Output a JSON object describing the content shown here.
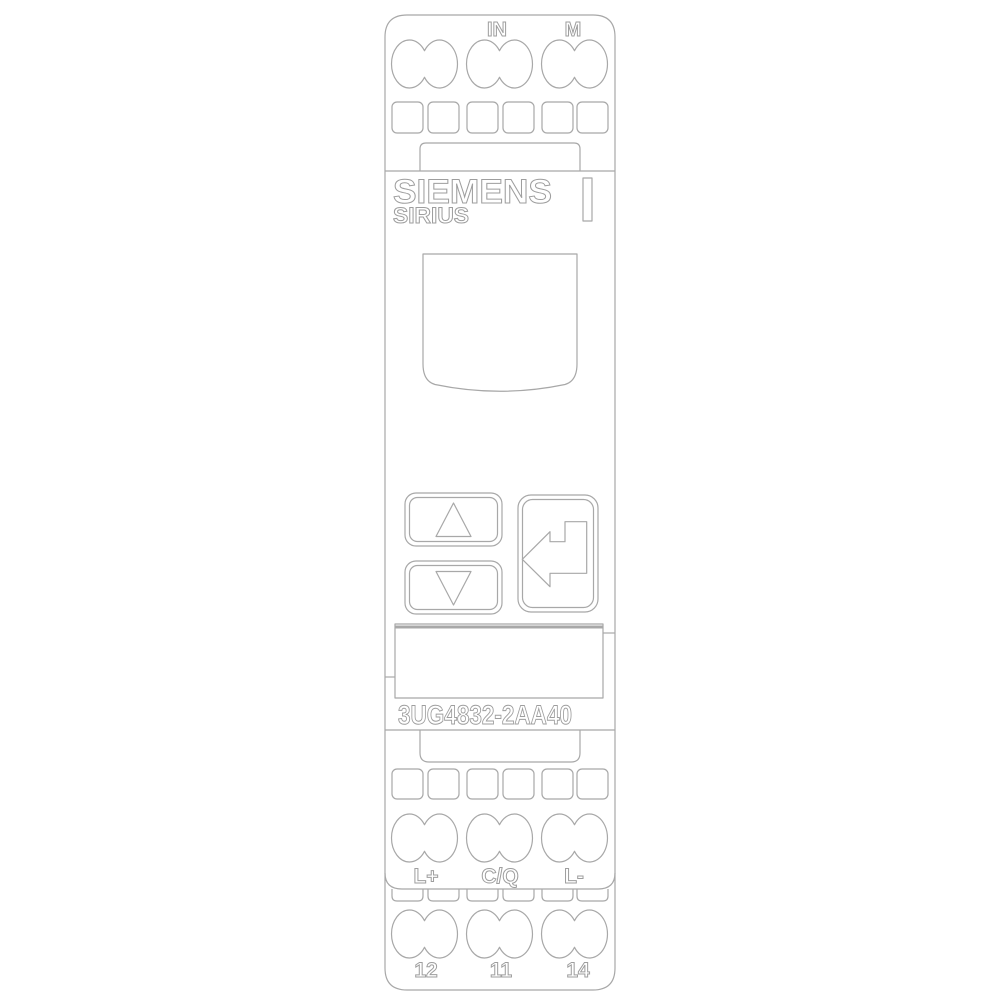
{
  "device": {
    "brand": "SIEMENS",
    "series": "SIRIUS",
    "model": "3UG4832-2AA40"
  },
  "terminals": {
    "top": {
      "labels": [
        "IN",
        "M"
      ]
    },
    "io": {
      "labels": [
        "L+",
        "C/Q",
        "L-"
      ]
    },
    "relay": {
      "labels": [
        "12",
        "11",
        "14"
      ]
    }
  },
  "buttons": {
    "up_icon": "up-arrow",
    "down_icon": "down-arrow",
    "enter_icon": "enter-arrow"
  },
  "colors": {
    "line": "#a8a8a8",
    "text_outline": "#9e9e9e",
    "background": "#ffffff"
  }
}
